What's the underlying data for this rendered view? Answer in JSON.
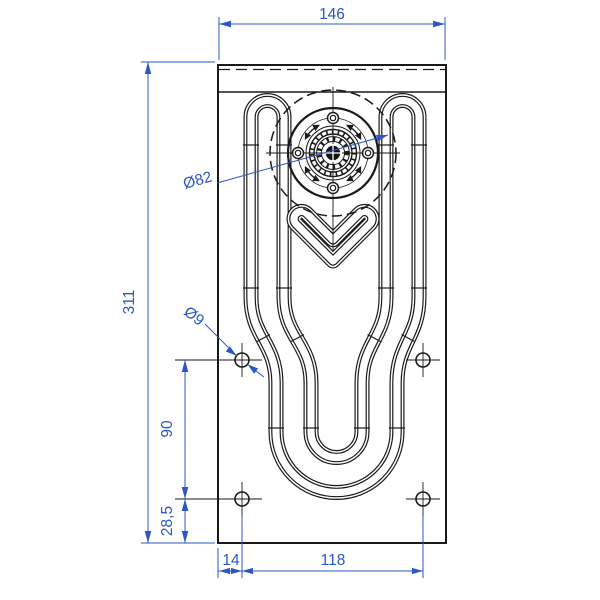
{
  "drawing": {
    "type": "technical-drawing",
    "part": "mounting plate with serpentine tube and bearing flange",
    "colors": {
      "line": "#1a1a1a",
      "dimension": "#2b57c8",
      "background": "#ffffff"
    },
    "dims": {
      "top_width": "146",
      "left_height": "311",
      "flange_diameter": "Ø82",
      "hole_diameter": "Ø9",
      "hole_pitch_vertical": "90",
      "bottom_offset": "28,5",
      "left_offset": "14",
      "hole_pitch_horizontal": "118"
    }
  }
}
